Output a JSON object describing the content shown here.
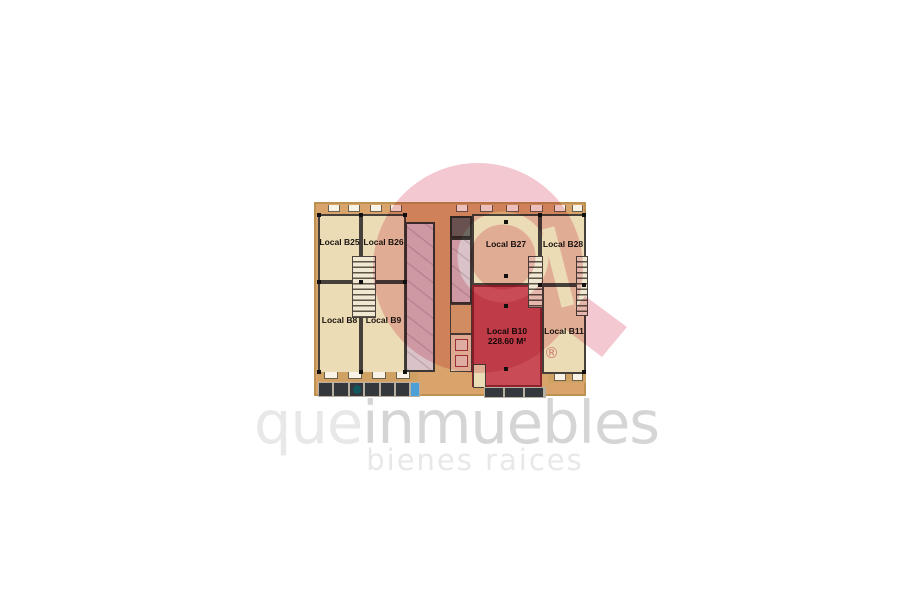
{
  "brand": {
    "word_part1": "que",
    "word_part2": "inmuebles",
    "tagline": "bienes raices",
    "registered_mark": "®",
    "logo_color": "#f4c8d1",
    "text_light_color": "#e8e8e8",
    "text_dark_color": "#d5d5d5"
  },
  "plan": {
    "highlight_color": "#c84b56",
    "room_color": "#ecdcb5",
    "corridor_color": "#d9a46c",
    "rooms": [
      {
        "id": "B25",
        "label": "Local B25"
      },
      {
        "id": "B26",
        "label": "Local B26"
      },
      {
        "id": "B27",
        "label": "Local B27"
      },
      {
        "id": "B28",
        "label": "Local B28"
      },
      {
        "id": "B8",
        "label": "Local B8"
      },
      {
        "id": "B9",
        "label": "Local B9"
      },
      {
        "id": "B10",
        "label": "Local B10",
        "area": "228.60 M²",
        "highlighted": true
      },
      {
        "id": "B11",
        "label": "Local B11"
      }
    ]
  }
}
